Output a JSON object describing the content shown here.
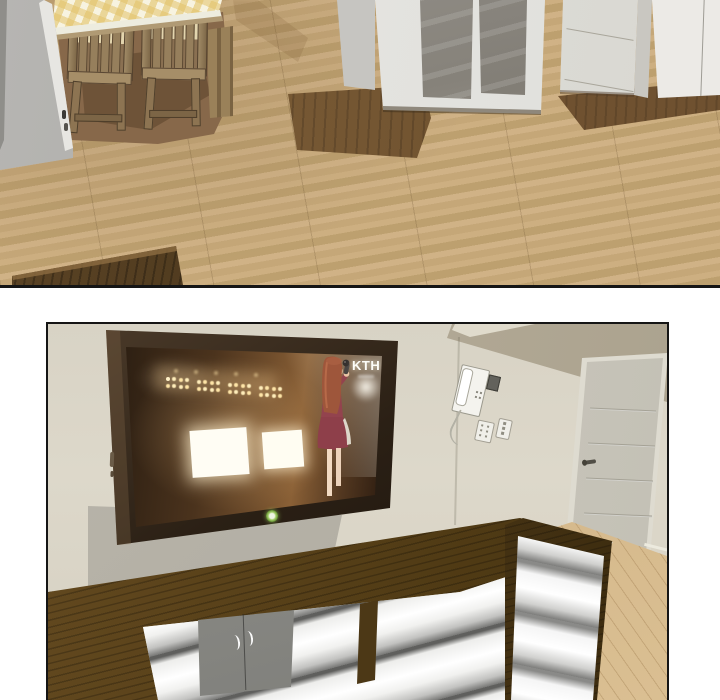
{
  "page": {
    "type": "webtoon-comic-page",
    "background_color": "#ffffff",
    "panel_count": 2
  },
  "panel1": {
    "name": "overhead-dining-room-scene",
    "objects": [
      "light-wood-plank-floor",
      "gray-door-left",
      "dining-table-with-gingham-cloth",
      "two-wooden-slat-back-chairs",
      "table-shadow",
      "glass-front-white-cabinet",
      "grooved-white-door",
      "dark-entry-walkway",
      "entry-mat",
      "tv-console-corner"
    ],
    "colors": {
      "floor": "#c9ab7d",
      "walkway": "#6f5330",
      "mat": "#9c7a4e",
      "cabinet": "#e9e8e4",
      "glass": "#8b877d",
      "table_cloth_yellow": "#e2c268",
      "chair_wood": "#967f5c",
      "shadow": "#87684a"
    }
  },
  "panel2": {
    "name": "living-room-tv-scene",
    "objects": [
      "beige-wall",
      "upper-taupe-wall",
      "wall-mounted-flat-tv",
      "tv-wall-shadow",
      "intercom-phone-unit",
      "light-switches",
      "grooved-interior-door",
      "wood-tv-console-with-white-curved-drawers",
      "gray-double-doors-with-white-handles",
      "light-wood-floor"
    ],
    "tv": {
      "logo": "KTH",
      "led_color": "#8bc34a",
      "screen_scene": "girl-in-red-dress-singing-with-microphone-on-stage",
      "screen_elements": [
        "stage-truss-lights",
        "two-bright-white-screens",
        "spotlight-beam",
        "singer-figure"
      ]
    },
    "colors": {
      "wall": "#dbd6c8",
      "upper_wall": "#b3aa97",
      "tv_frame": "#241a12",
      "screen_warm_brown": "#6e4c2b",
      "singer_dress": "#8e3f4a",
      "singer_hair": "#9e563b",
      "console_wood": "#54401f",
      "drawer_white": "#ffffff",
      "door": "#cbc8bd",
      "floor": "#d3b284",
      "shadow_gray": "#b5b1a6"
    }
  }
}
